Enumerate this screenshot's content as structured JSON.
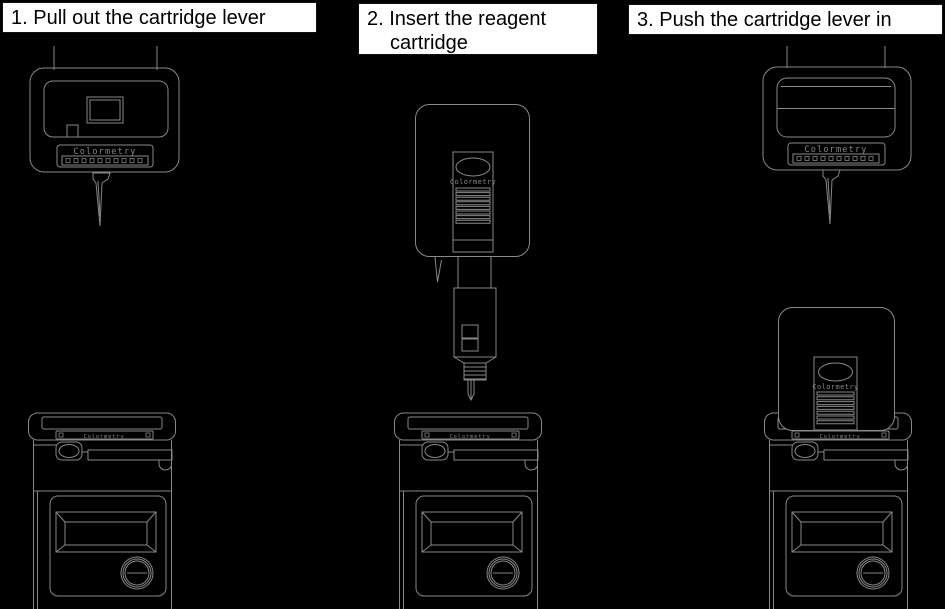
{
  "colors": {
    "background": "#000000",
    "caption_box_background": "#ffffff",
    "caption_text": "#000000",
    "artwork_line": "#888888"
  },
  "steps": [
    {
      "line1": "1. Pull out the cartridge lever",
      "line2": ""
    },
    {
      "line1": "2. Insert the reagent",
      "line2": "cartridge"
    },
    {
      "line1": "3. Push the cartridge lever in",
      "line2": ""
    }
  ],
  "artwork": {
    "device_label": "Colormetry",
    "cartridge_label": "Colormetry",
    "front_cap_label": "Colormetry"
  }
}
